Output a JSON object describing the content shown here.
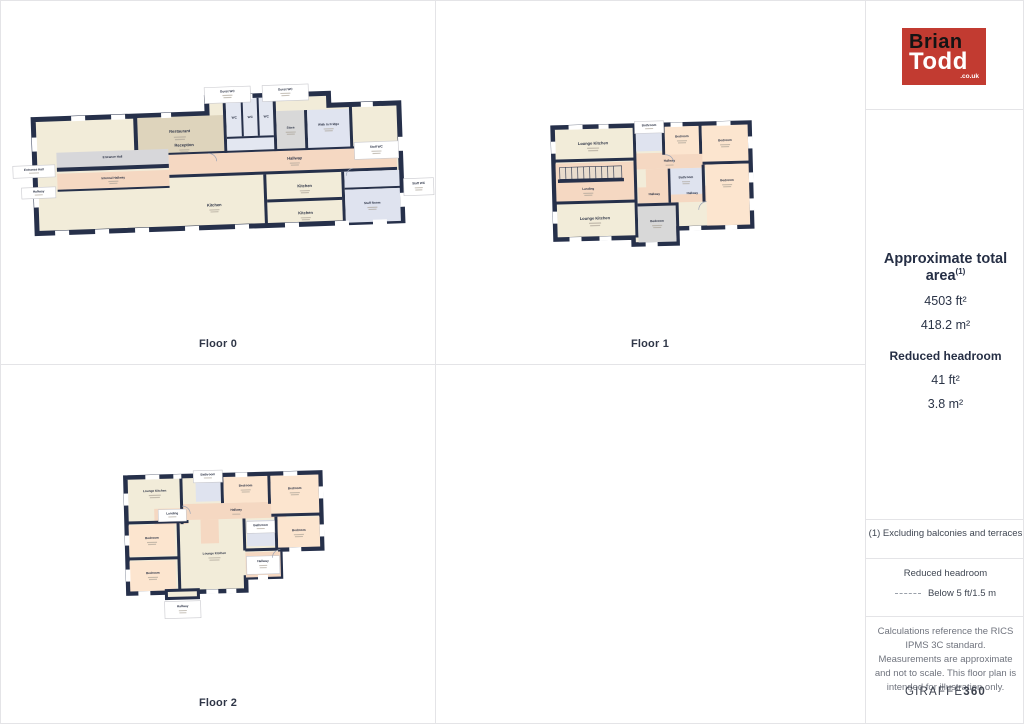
{
  "brand": {
    "logo_line1": "Brian",
    "logo_line2": "Todd",
    "logo_suffix": ".co.uk",
    "logo_bg": "#c23b31"
  },
  "sidebar": {
    "area_title": "Approximate total area",
    "area_sup": "(1)",
    "area_ft": "4503 ft²",
    "area_m": "418.2 m²",
    "reduced_headroom_title": "Reduced headroom",
    "reduced_headroom_ft": "41 ft²",
    "reduced_headroom_m": "3.8 m²",
    "note": "(1) Excluding balconies and terraces",
    "legend_title": "Reduced headroom",
    "legend_label": "Below 5 ft/1.5 m",
    "disclaimer": "Calculations reference the RICS IPMS 3C standard. Measurements are approximate and not to scale. This floor plan is intended for illustration only.",
    "credit_normal": "GIRAFFE",
    "credit_bold": "360"
  },
  "colors": {
    "wall": "#26304a",
    "floor_cream": "#f2ecd9",
    "restaurant_tan": "#ded4bc",
    "bedroom_peach": "#fce5cf",
    "hallway_pink": "#f5d8c2",
    "wet_room_blue": "#dfe3ef",
    "store_gray": "#d8d8d8",
    "brand_red": "#c23b31"
  },
  "floors": [
    {
      "label": "Floor 0",
      "rooms": {
        "entrance_hall_callout": "Entrance Hall",
        "hallway_callout": "Hallway",
        "entrance_hall": "Entrance Hall",
        "internal_hallway": "Internal Hallway",
        "reception": "Reception",
        "restaurant": "Restaurant",
        "guest_wc1": "Guest WC",
        "guest_wc2": "Guest WC",
        "wc1": "WC",
        "wc2": "WC",
        "wc3": "WC",
        "store": "Store",
        "walk_in_fridge": "Walk In Fridge",
        "hallway": "Hallway",
        "staff_wc1": "Staff WC",
        "kitchen1": "Kitchen",
        "kitchen2": "Kitchen",
        "kitchen3": "Kitchen",
        "staff_room": "Staff Room",
        "staff_wc2": "Staff WC"
      }
    },
    {
      "label": "Floor 1",
      "rooms": {
        "lounge_kitchen1": "Lounge Kitchen",
        "bathroom1": "Bathroom",
        "bedroom1": "Bedroom",
        "bedroom2": "Bedroom",
        "hallway1": "Hallway",
        "landing": "Landing",
        "bathroom2": "Bathroom",
        "bedroom3": "Bedroom",
        "hallway2": "Hallway",
        "hallway3": "Hallway",
        "lounge_kitchen2": "Lounge Kitchen",
        "bedroom4": "Bedroom"
      }
    },
    {
      "label": "Floor 2",
      "rooms": {
        "lounge_kitchen1": "Lounge Kitchen",
        "bathroom1": "Bathroom",
        "bedroom1": "Bedroom",
        "bedroom2": "Bedroom",
        "hallway1": "Hallway",
        "landing": "Landing",
        "bedroom3": "Bedroom",
        "bedroom4": "Bedroom",
        "lounge_kitchen2": "Lounge Kitchen",
        "bathroom2": "Bathroom",
        "bedroom5": "Bedroom",
        "hallway_callout_right": "Hallway",
        "hallway_callout_bottom": "Hallway"
      }
    }
  ]
}
